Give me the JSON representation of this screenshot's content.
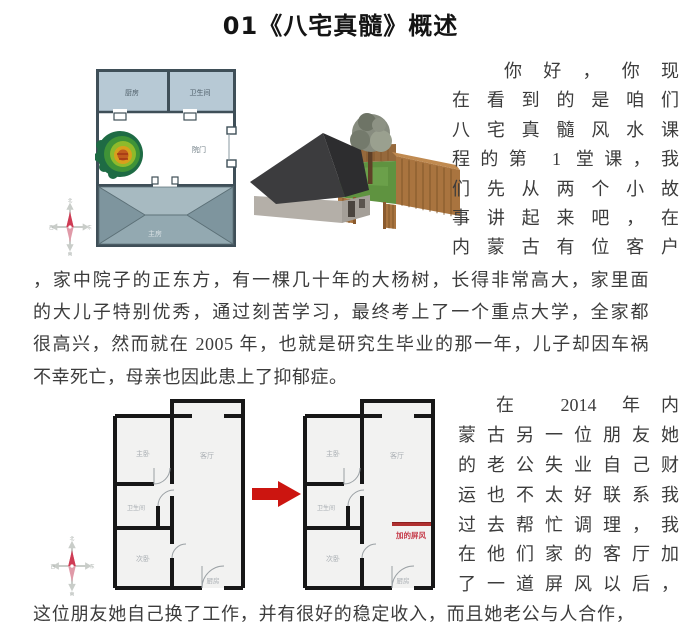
{
  "title": "01《八宅真髓》概述",
  "colors": {
    "arrow_red": "#cc1510",
    "screen_red": "#b03030",
    "screen_text_red": "#c63c4a",
    "plan_wall_dark": "#3f4f58",
    "apartment_wall": "#171717",
    "room_fill_blue": "#b7c9d5"
  },
  "compass": {
    "n": "北",
    "s": "南",
    "w": "西",
    "e": "东"
  },
  "plan1": {
    "room_top_left": "厨房",
    "room_top_right": "卫生间",
    "gate_label": "院门",
    "main_room": "主房"
  },
  "section1_lines": [
    "你好，你现",
    "在看到的是咱们",
    "八宅真髓风水课",
    "程的第 1 堂课，我",
    "们先从两个小故",
    "事讲起来吧，在",
    "内蒙古有位客户"
  ],
  "paragraph1_lines": [
    "，家中院子的正东方，有一棵几十年的大杨树，长得非常高大，家里面",
    "的大儿子特别优秀，通过刻苦学习，最终考上了一个重点大学，全家都",
    "很高兴，然而就在 2005 年，也就是研究生毕业的那一年，儿子却因车祸",
    "不幸死亡，母亲也因此患上了抑郁症。"
  ],
  "plan2": {
    "master_bedroom": "主卧",
    "living_room": "客厅",
    "bathroom": "卫生间",
    "second_bedroom": "次卧",
    "kitchen": "厨房",
    "screen_label": "加的屏风"
  },
  "section2_lines": [
    "在 2014 年内",
    "蒙古另一位朋友她",
    "的老公失业自己财",
    "运也不太好联系我",
    "过去帮忙调理，我",
    "在他们家的客厅加",
    "了一道屏风以后，"
  ],
  "closing_line": "这位朋友她自己换了工作，并有很好的稳定收入，而且她老公与人合作，"
}
